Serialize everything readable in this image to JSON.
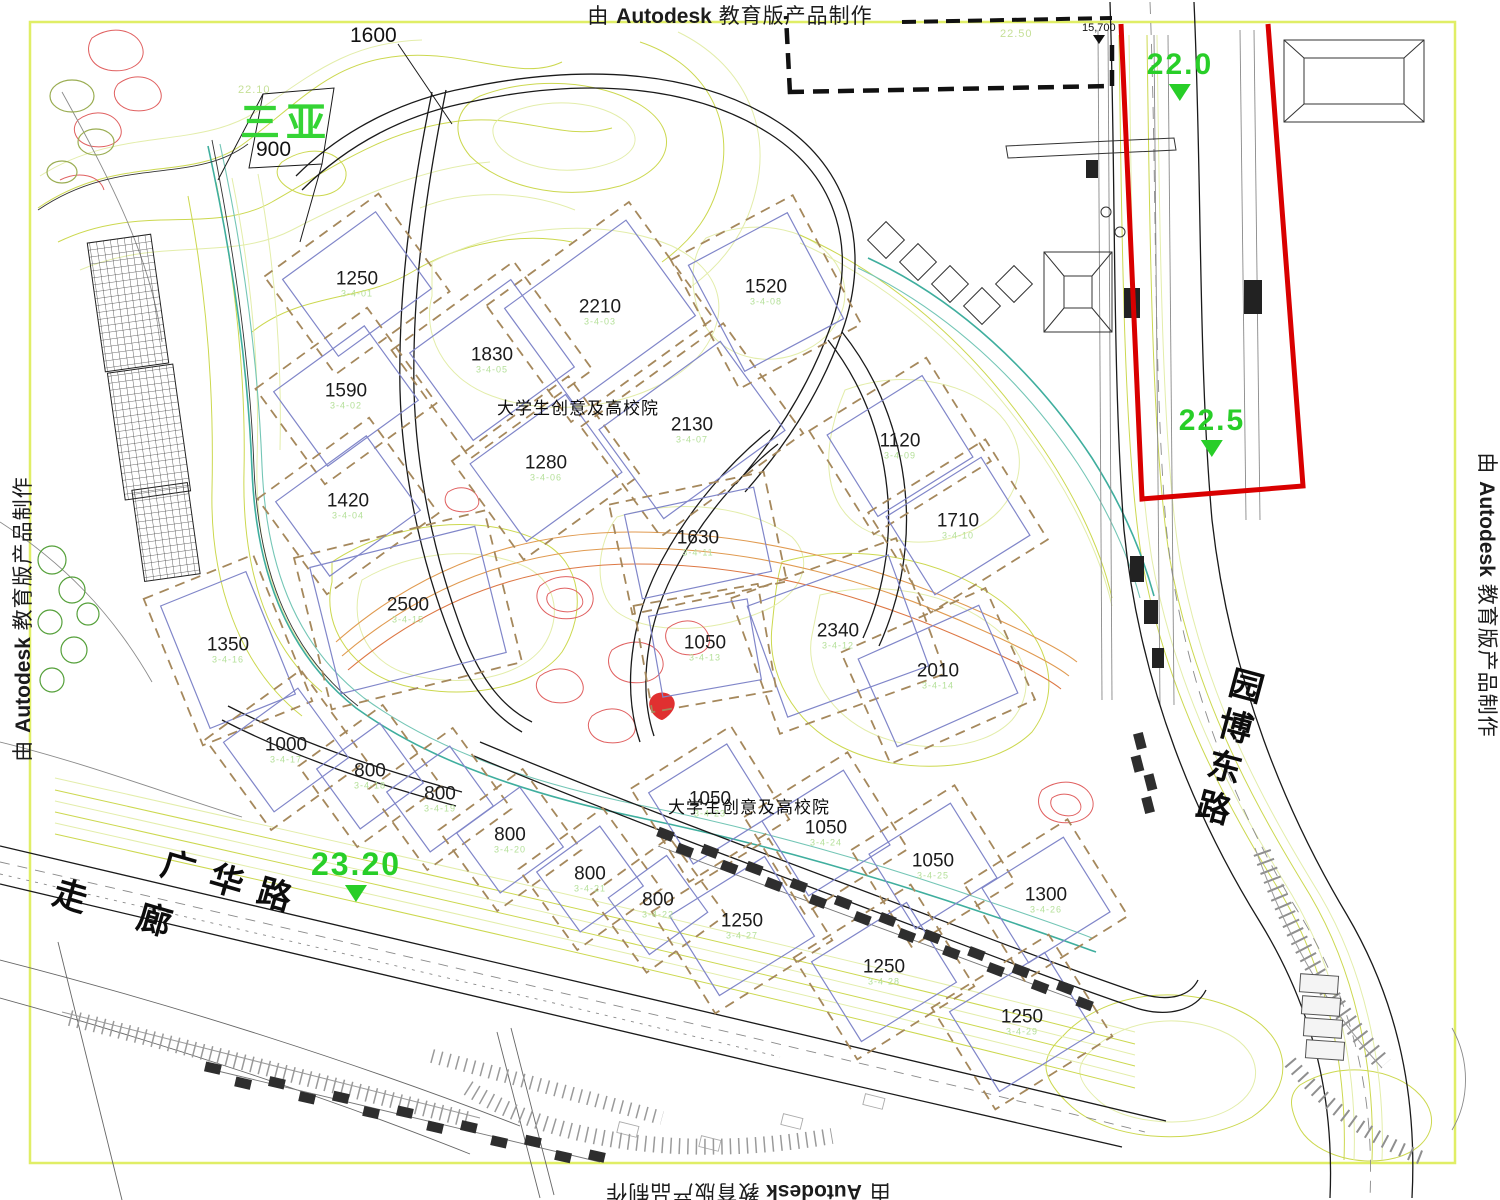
{
  "watermark": {
    "prefix": "由",
    "brand": "Autodesk",
    "suffix": "教育版产品制作"
  },
  "colors": {
    "boundary_red": "#d90000",
    "elevation_green": "#28ce28",
    "parcel_blue": "#8086c9",
    "setback_brown": "#a5885c",
    "contour_green": "#ccd84f",
    "frame_yellow": "#e0ee66"
  },
  "site": {
    "name_label": "三亚",
    "name_value": "900",
    "top_plot": "1600",
    "district_label": "大学生创意及高校院",
    "dim_label": "15,700",
    "contour_label_right": "22.50",
    "contour_label_left": "22.10"
  },
  "roads": {
    "guanghua": "广华路",
    "corridor": "走 廊",
    "yuanbo": "园博东路"
  },
  "elevations": [
    {
      "value": "22.0",
      "x": 1180,
      "y": 48,
      "size": 30
    },
    {
      "value": "22.5",
      "x": 1212,
      "y": 404,
      "size": 30
    },
    {
      "value": "23.20",
      "x": 356,
      "y": 846,
      "size": 32
    }
  ],
  "plots": [
    {
      "number": "1250",
      "code": "3-4-01",
      "x": 357,
      "y": 284,
      "w": 115,
      "h": 95,
      "a": -36
    },
    {
      "number": "2210",
      "code": "3-4-03",
      "x": 600,
      "y": 312,
      "w": 150,
      "h": 118,
      "a": -36
    },
    {
      "number": "1830",
      "code": "3-4-05",
      "x": 492,
      "y": 360,
      "w": 125,
      "h": 108,
      "a": -36
    },
    {
      "number": "1590",
      "code": "3-4-02",
      "x": 346,
      "y": 396,
      "w": 112,
      "h": 92,
      "a": -36
    },
    {
      "number": "1280",
      "code": "3-4-06",
      "x": 546,
      "y": 468,
      "w": 118,
      "h": 96,
      "a": -36
    },
    {
      "number": "2130",
      "code": "3-4-07",
      "x": 692,
      "y": 430,
      "w": 150,
      "h": 110,
      "a": -36
    },
    {
      "number": "1420",
      "code": "3-4-04",
      "x": 348,
      "y": 506,
      "w": 112,
      "h": 92,
      "a": -36
    },
    {
      "number": "1520",
      "code": "3-4-08",
      "x": 766,
      "y": 292,
      "w": 112,
      "h": 120,
      "a": -28
    },
    {
      "number": "1120",
      "code": "3-4-09",
      "x": 900,
      "y": 446,
      "w": 112,
      "h": 96,
      "a": -32
    },
    {
      "number": "1710",
      "code": "3-4-10",
      "x": 958,
      "y": 526,
      "w": 112,
      "h": 92,
      "a": -32
    },
    {
      "number": "1630",
      "code": "3-4-11",
      "x": 698,
      "y": 543,
      "w": 132,
      "h": 86,
      "a": -12
    },
    {
      "number": "2340",
      "code": "3-4-12",
      "x": 838,
      "y": 636,
      "w": 150,
      "h": 118,
      "a": -20
    },
    {
      "number": "1050",
      "code": "3-4-13",
      "x": 705,
      "y": 648,
      "w": 100,
      "h": 82,
      "a": -10
    },
    {
      "number": "2010",
      "code": "3-4-14",
      "x": 938,
      "y": 676,
      "w": 132,
      "h": 96,
      "a": -24
    },
    {
      "number": "2500",
      "code": "3-4-15",
      "x": 408,
      "y": 610,
      "w": 170,
      "h": 130,
      "a": -14
    },
    {
      "number": "1350",
      "code": "3-4-16",
      "x": 228,
      "y": 650,
      "w": 92,
      "h": 132,
      "a": -22
    },
    {
      "number": "1000",
      "code": "3-4-17",
      "x": 286,
      "y": 750,
      "w": 92,
      "h": 86,
      "a": -36
    },
    {
      "number": "800",
      "code": "3-4-18",
      "x": 370,
      "y": 776,
      "w": 78,
      "h": 74,
      "a": -36
    },
    {
      "number": "800",
      "code": "3-4-19",
      "x": 440,
      "y": 799,
      "w": 78,
      "h": 74,
      "a": -36
    },
    {
      "number": "800",
      "code": "3-4-20",
      "x": 510,
      "y": 840,
      "w": 78,
      "h": 74,
      "a": -36
    },
    {
      "number": "800",
      "code": "3-4-21",
      "x": 590,
      "y": 879,
      "w": 78,
      "h": 74,
      "a": -36
    },
    {
      "number": "800",
      "code": "3-4-22",
      "x": 658,
      "y": 905,
      "w": 72,
      "h": 70,
      "a": -36
    },
    {
      "number": "1050",
      "code": "3-4-23",
      "x": 710,
      "y": 804,
      "w": 92,
      "h": 84,
      "a": -32
    },
    {
      "number": "1050",
      "code": "3-4-24",
      "x": 826,
      "y": 833,
      "w": 96,
      "h": 88,
      "a": -32
    },
    {
      "number": "1050",
      "code": "3-4-25",
      "x": 933,
      "y": 866,
      "w": 96,
      "h": 88,
      "a": -32
    },
    {
      "number": "1300",
      "code": "3-4-26",
      "x": 1046,
      "y": 900,
      "w": 96,
      "h": 88,
      "a": -32
    },
    {
      "number": "1250",
      "code": "3-4-27",
      "x": 742,
      "y": 926,
      "w": 112,
      "h": 94,
      "a": -32
    },
    {
      "number": "1250",
      "code": "3-4-28",
      "x": 884,
      "y": 972,
      "w": 112,
      "h": 94,
      "a": -32
    },
    {
      "number": "1250",
      "code": "3-4-29",
      "x": 1022,
      "y": 1022,
      "w": 112,
      "h": 94,
      "a": -32
    }
  ]
}
